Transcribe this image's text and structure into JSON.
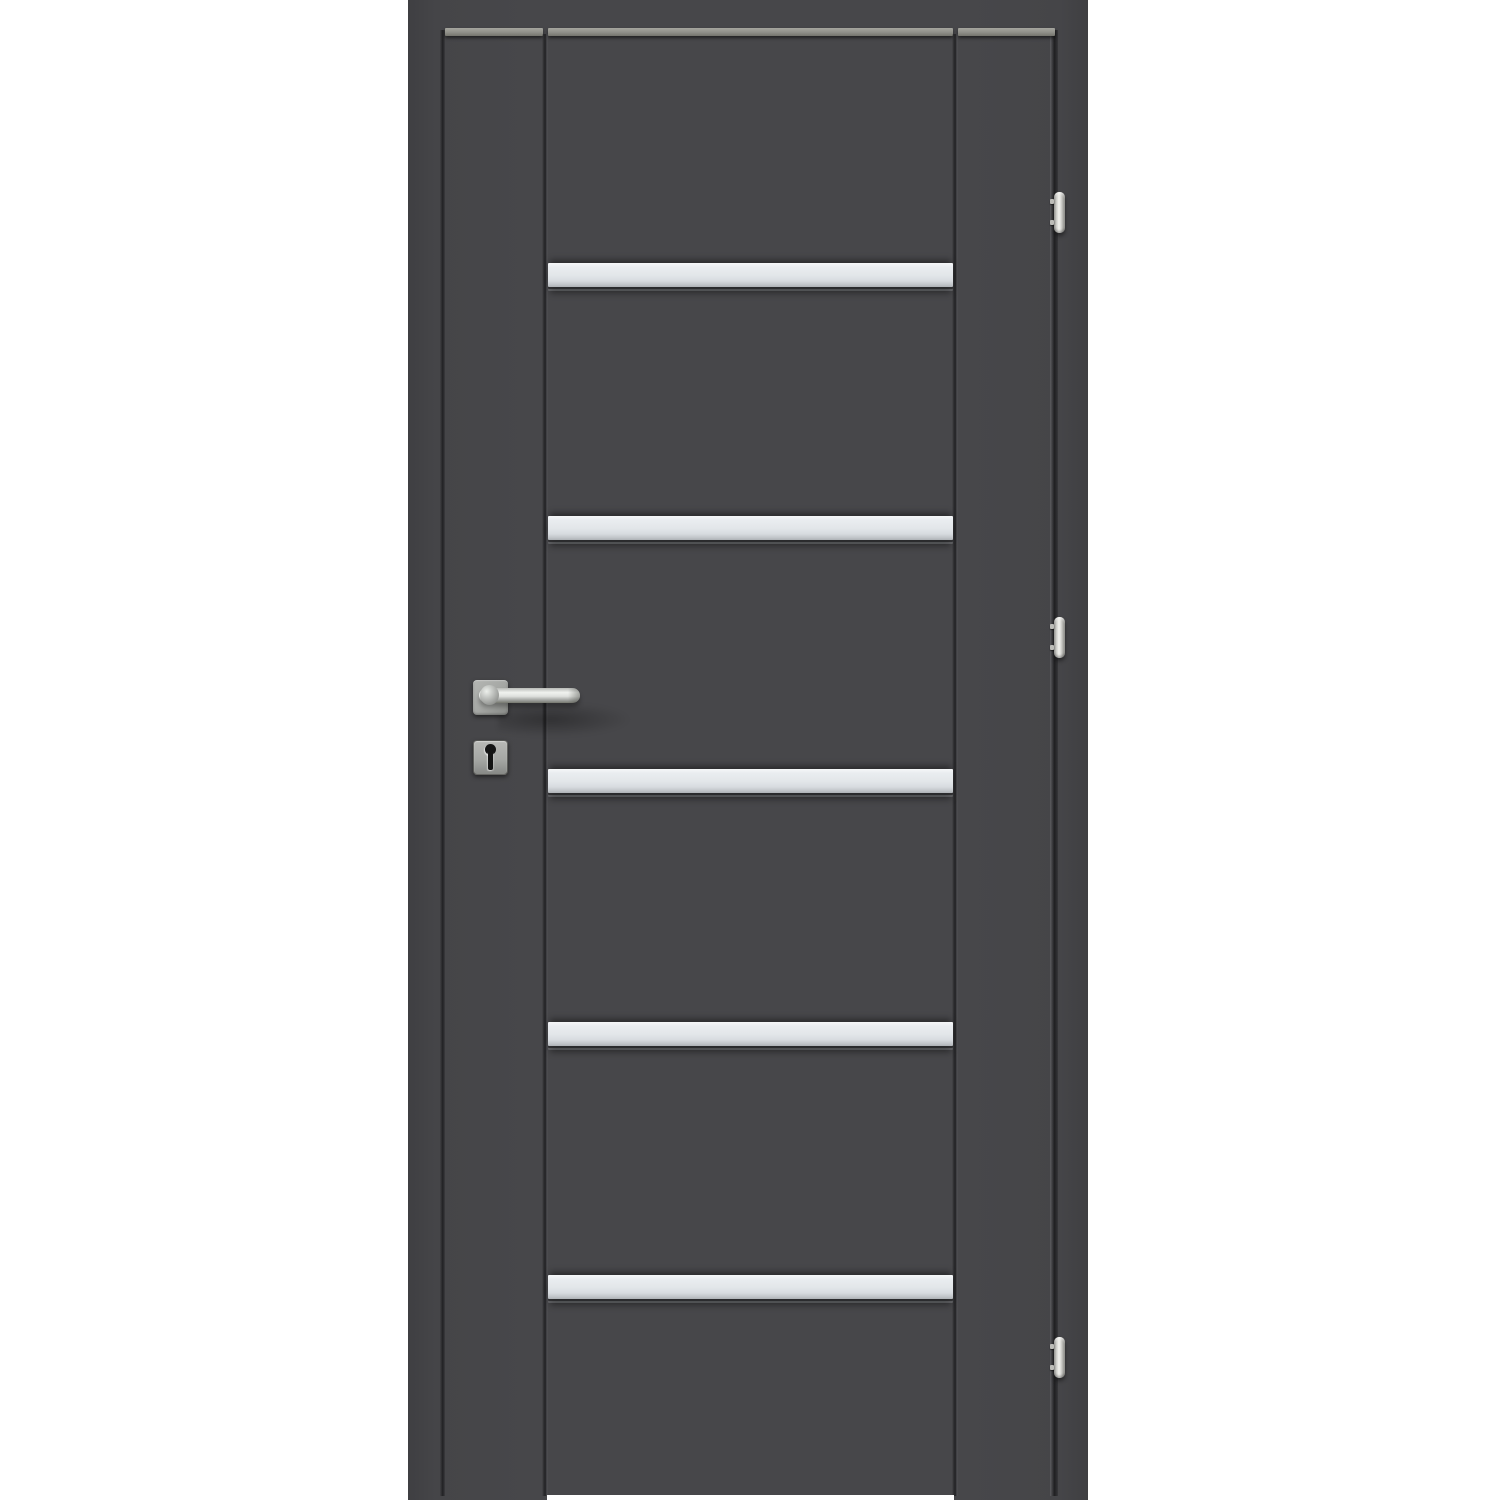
{
  "scene": {
    "description": "Product photo of a closed anthracite-grey interior door with its frame: five horizontal satin glass / aluminium inlay strips across the centre, a stainless-steel lever handle on a square rosette with a square keyhole escutcheon below it on the left stile, and three stainless barrel hinges on the right edge.",
    "background_color": "#ffffff"
  },
  "colors": {
    "background": "#ffffff",
    "leaf": "#47474a",
    "leaf_edge": "#3f3f42",
    "frame": "#454548",
    "top_edge": "#8f8f89",
    "strip": "#e2e6e9",
    "strip_highlight": "#f5f7f8",
    "strip_shade": "#aeb2b6",
    "metal_light": "#f0f2ef",
    "metal_mid": "#a6a8a5",
    "metal_dark": "#75776f",
    "keyhole": "#141414"
  },
  "door": {
    "glass_strips_count": 5,
    "hinges_count": 3,
    "hinge_side": "right",
    "handle_side": "left",
    "hardware_finish": "stainless steel"
  }
}
